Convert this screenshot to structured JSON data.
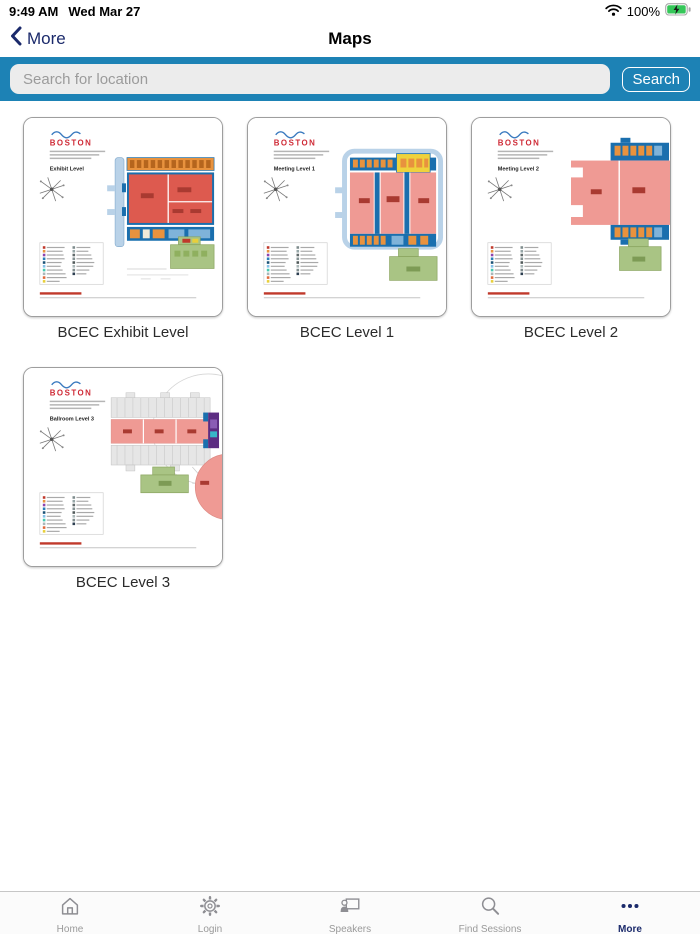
{
  "status_bar": {
    "time": "9:49 AM",
    "date": "Wed Mar 27",
    "battery_percent": "100%"
  },
  "nav": {
    "back_label": "More",
    "title": "Maps"
  },
  "search": {
    "placeholder": "Search for location",
    "button_label": "Search"
  },
  "maps": [
    {
      "caption": "BCEC Exhibit Level",
      "level_label": "Exhibit Level",
      "logo_text": "BOSTON"
    },
    {
      "caption": "BCEC Level 1",
      "level_label": "Meeting Level 1",
      "logo_text": "BOSTON"
    },
    {
      "caption": "BCEC Level 2",
      "level_label": "Meeting Level 2",
      "logo_text": "BOSTON"
    },
    {
      "caption": "BCEC Level 3",
      "level_label": "Ballroom Level 3",
      "logo_text": "BOSTON"
    }
  ],
  "tab_bar": {
    "items": [
      {
        "label": "Home"
      },
      {
        "label": "Login"
      },
      {
        "label": "Speakers"
      },
      {
        "label": "Find Sessions"
      },
      {
        "label": "More"
      }
    ],
    "active_item": "More"
  },
  "colors": {
    "search_bar_blue": "#1d82b5",
    "nav_navy": "#1b2a6b",
    "tab_inactive_gray": "#8e8e93",
    "battery_green": "#35c759",
    "map_hall_red": "#dd5a4f",
    "map_pink": "#ef9a94",
    "map_dark_blue": "#1a6fae",
    "map_orange": "#e8923e",
    "map_green": "#a9c484",
    "map_yellow": "#efd23c",
    "map_purple": "#5c2d82"
  }
}
